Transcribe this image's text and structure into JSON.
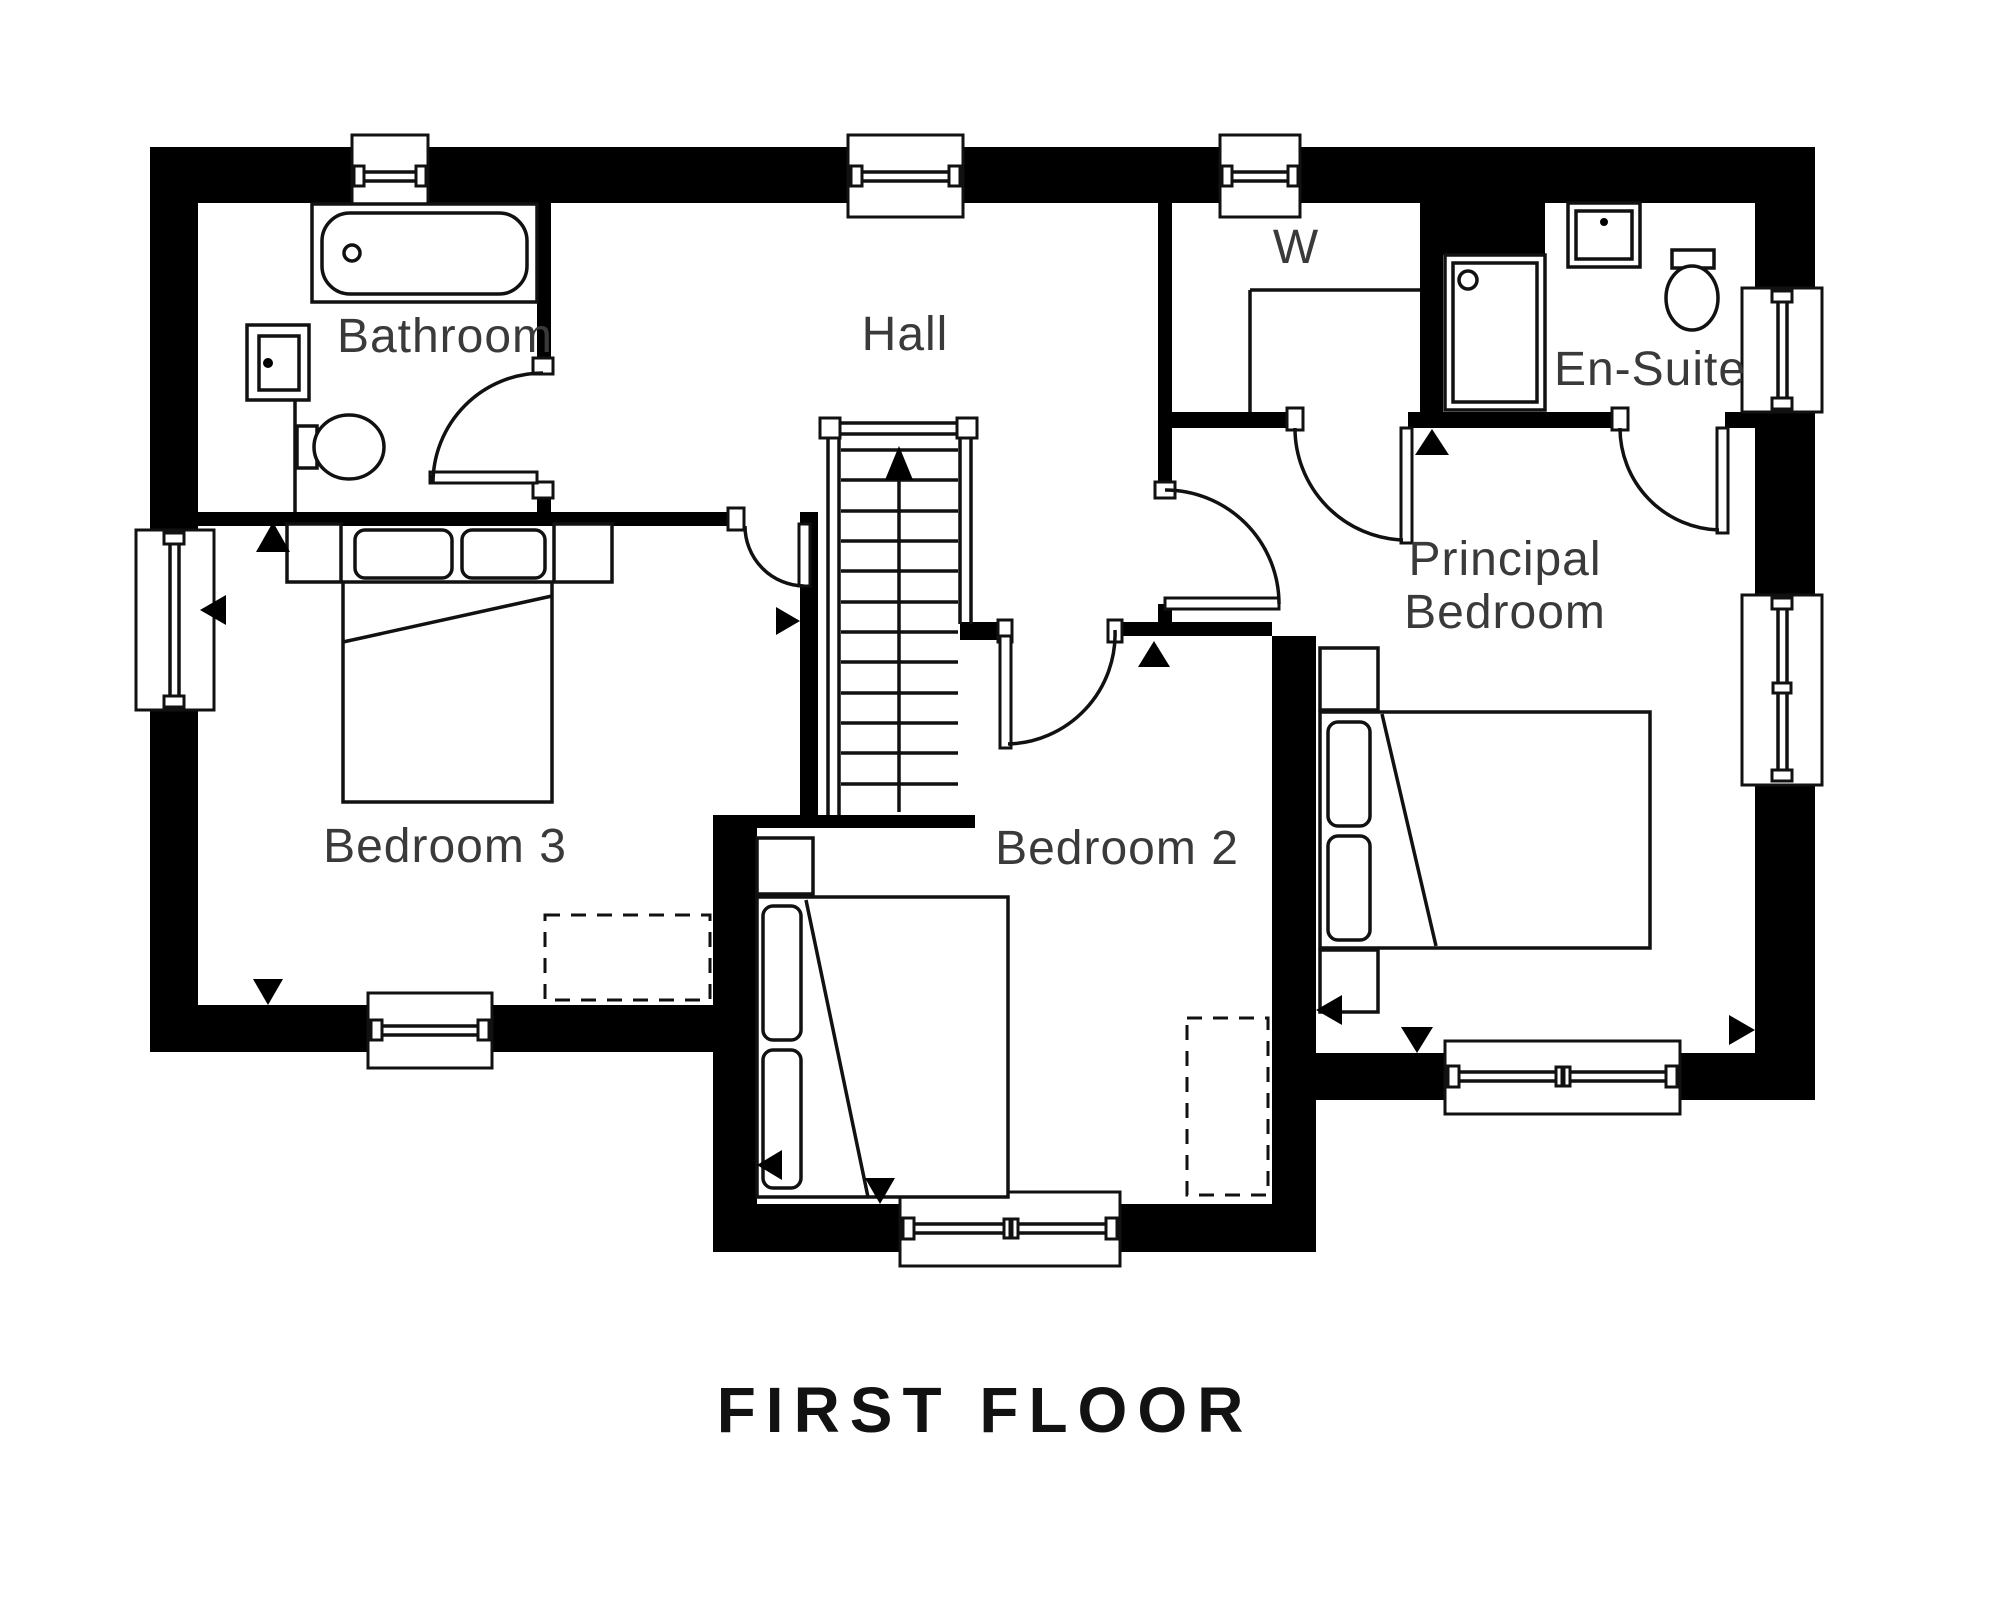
{
  "title": "FIRST FLOOR",
  "rooms": {
    "bathroom": "Bathroom",
    "hall": "Hall",
    "wardrobe": "W",
    "ensuite": "En-Suite",
    "principal_line1": "Principal",
    "principal_line2": "Bedroom",
    "bedroom3": "Bedroom 3",
    "bedroom2": "Bedroom 2"
  },
  "colors": {
    "wall": "#000000",
    "line": "#111111",
    "label": "#3a3a3a",
    "background": "#ffffff"
  }
}
